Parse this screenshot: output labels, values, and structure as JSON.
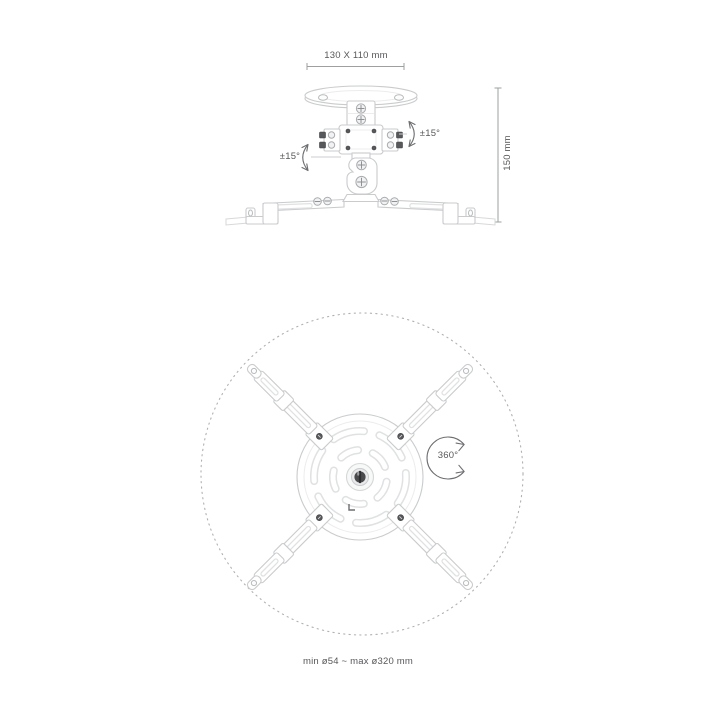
{
  "product": "projector-ceiling-mount-diagram",
  "side_view": {
    "plate_dimension_label": "130 X 110 mm",
    "height_label": "150 mm",
    "tilt_left_label": "±15°",
    "tilt_right_label": "±15°"
  },
  "top_view": {
    "rotation_label": "360°",
    "mount_range_label": "min ø54 ~ max ø320 mm"
  },
  "colors": {
    "background": "#ffffff",
    "dimension_text": "#57585a",
    "dimension_line": "#9da0a2",
    "product_outline": "#c9cbcd",
    "dotted_circle": "#aeb0b2",
    "screw_dark": "#56585b"
  }
}
